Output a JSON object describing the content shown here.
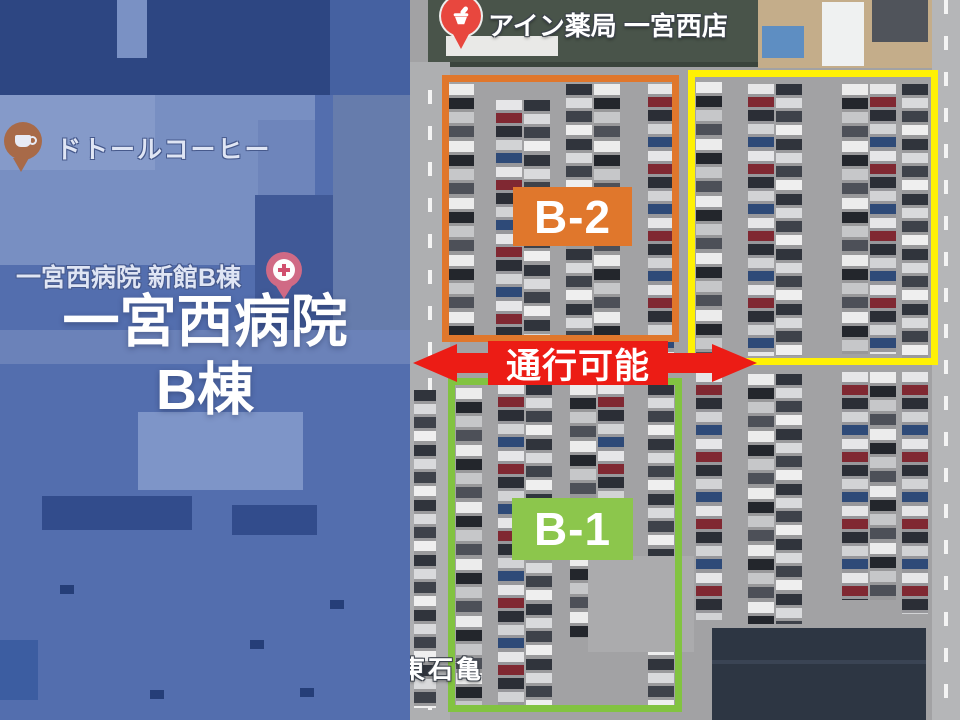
{
  "region_label": {
    "line1": "一宮西病院",
    "line2": "B棟"
  },
  "poi": {
    "pharmacy": "アイン薬局 一宮西店",
    "coffee": "ドトールコーヒー",
    "hospital_annex": "一宮西病院 新館B棟",
    "street": "東石亀"
  },
  "zones": {
    "b2": {
      "label": "B-2",
      "color": "#e0772c"
    },
    "b1": {
      "label": "B-1",
      "color": "#8cc64c"
    },
    "parking_ok": {
      "label": "駐車可能エリア",
      "color": "#fff104"
    },
    "passage": {
      "label": "通行可能",
      "color": "#ec1c15"
    }
  }
}
